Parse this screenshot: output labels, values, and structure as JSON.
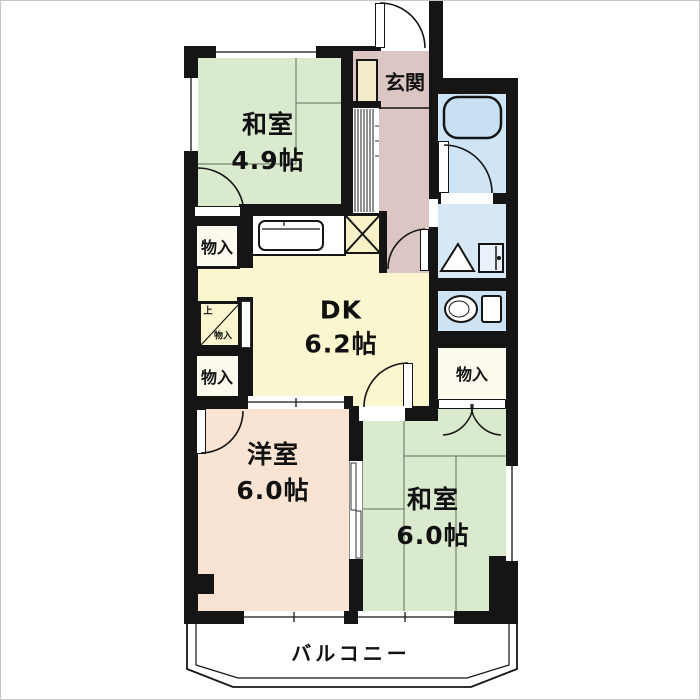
{
  "floorplan": {
    "type": "japanese-apartment-floor-plan",
    "rooms": [
      {
        "id": "washitsu-49",
        "name": "和室",
        "area": "4.9帖"
      },
      {
        "id": "genkan",
        "name": "玄関",
        "area": ""
      },
      {
        "id": "dk",
        "name": "DK",
        "area": "6.2帖"
      },
      {
        "id": "youshitsu-60",
        "name": "洋室",
        "area": "6.0帖"
      },
      {
        "id": "washitsu-60",
        "name": "和室",
        "area": "6.0帖"
      },
      {
        "id": "balcony",
        "name": "バルコニー",
        "area": ""
      }
    ],
    "storages": {
      "left_top": "物入",
      "left_bottom": "物入",
      "right": "物入",
      "nook_line1": "上",
      "nook_line2": "物入"
    },
    "fixtures": [
      "bathtub",
      "toilet",
      "washing-machine-pan",
      "kitchen-sink",
      "stove",
      "shoe-cabinet"
    ],
    "colors": {
      "tatami_room": "#d9eace",
      "dk": "#f9f6d0",
      "western_room": "#f9e3d2",
      "entrance_hall": "#dcc6c3",
      "wet_area": "#cfe4f5",
      "storage": "#fbfaec",
      "wall": "#151515",
      "balcony_floor": "#ffffff"
    }
  }
}
